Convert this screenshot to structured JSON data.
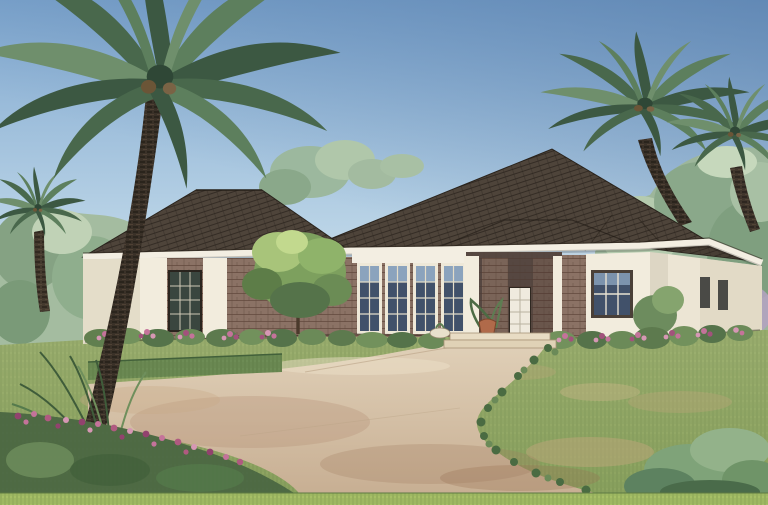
{
  "meta": {
    "type": "watercolor architectural rendering",
    "subject": "single-story stucco and brick house with hip roof, palm trees, curved driveway",
    "width_px": 768,
    "height_px": 505
  },
  "palette": {
    "sky_top": "#7fa7cf",
    "sky_mid": "#b9d3e6",
    "sky_low": "#e7e2dc",
    "sky_horizon": "#f2e7da",
    "background_trees": "#9db69b",
    "background_trees_left": "#a4bca0",
    "roof": "#4e443a",
    "roof_wrap": "#473e34",
    "fascia": "#f3eee2",
    "stucco": "#f2ecdd",
    "stucco_shade": "#e4ddc9",
    "brick": "#8b7265",
    "porch_shadow": "#564741",
    "glass": "#41516a",
    "glass_light": "#8ba3bd",
    "bay_glass": "#3a463f",
    "door": "#efeade",
    "driveway_light": "#e0d0b8",
    "driveway_dark": "#c7ae92",
    "walk_seam": "#b9a285",
    "lawn": "#9db070",
    "lawn_dark": "#8aa25e",
    "grass_strip": "#a6bf66",
    "hedge": "#6d8c55",
    "shrub": "#5d7a4e",
    "shrub_light": "#7d9b60",
    "bed_green": "#4f6b45",
    "flower_pink": "#c4739a",
    "flower_magenta": "#92426e",
    "flower_light": "#d697b4",
    "lavender": "#b4a2c2",
    "palm_trunk": "#3a3128",
    "frond_dark": "#3c5842",
    "frond_mid": "#5d7f5d",
    "frond_light": "#6f8f6c",
    "terracotta": "#b06a4a",
    "step_stone": "#e8dcc4"
  },
  "scene": {
    "sky": {
      "description": "clear wash sky, deeper blue upper corners, pale pink near horizon"
    },
    "house": {
      "stories": 1,
      "roof": "dark shingled hip roof with secondary hips over entry and bays",
      "walls": "white stucco with brick piers and brick accent sections",
      "front_door": "white panel door in recessed shadowed entry",
      "window_groups": [
        "left bay dark multi-pane window",
        "central bank of four tall french-style windows",
        "right bay picture window with blue glass",
        "two narrow windows on right wing"
      ],
      "planters": "terracotta pot and small white bowl at entry walk"
    },
    "trees": {
      "palms": [
        {
          "position": "left foreground",
          "size": "large, trunk to ground"
        },
        {
          "position": "far left background",
          "size": "small"
        },
        {
          "position": "right, behind roof",
          "size": "large"
        },
        {
          "position": "far right edge",
          "size": "medium"
        }
      ],
      "front_yard_tree": "small round bright-green ornamental tree in front of left wall"
    },
    "ground": {
      "driveway": "broad curved tan driveway sweeping from lower left",
      "walkway": "walk with two light stone steps up to the entry",
      "lawn": "hatched green lawn with dry tan patches on right",
      "beds": [
        "foundation shrubs with pink flower drifts along the house",
        "foreground bed of magenta flowers and grasses at lower left",
        "blue-green shrub cluster at lower right",
        "clipped hedge along upper driveway edge"
      ]
    }
  }
}
